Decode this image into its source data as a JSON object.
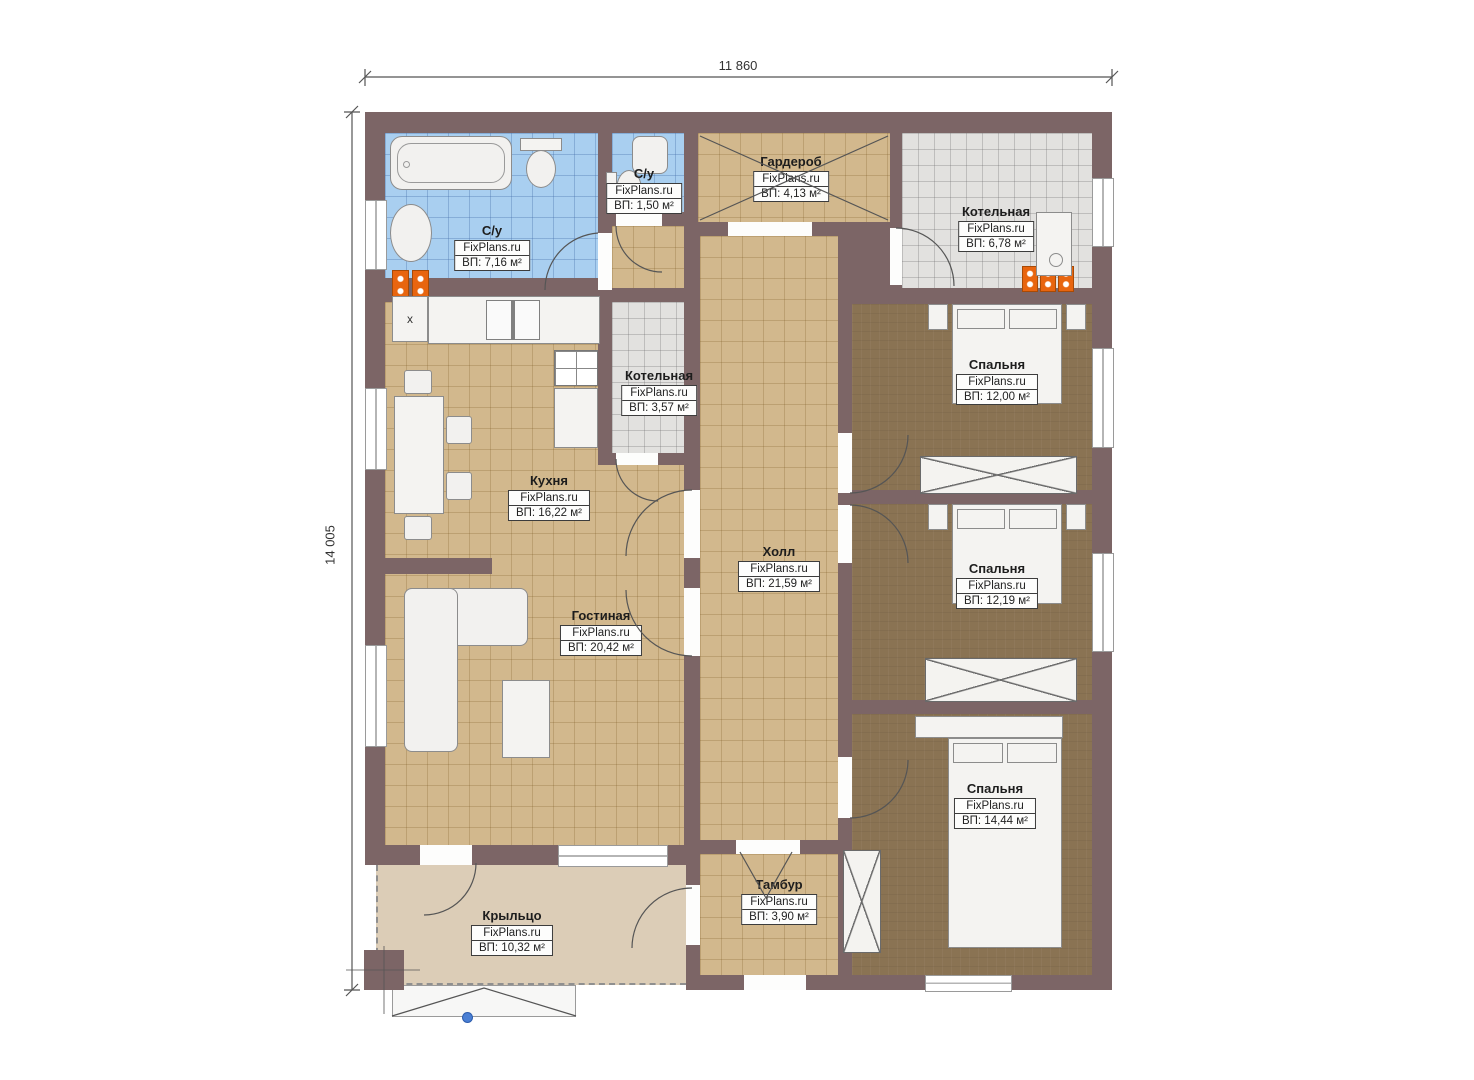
{
  "dimensions": {
    "width_label": "11 860",
    "height_label": "14 005"
  },
  "watermark": "FixPlans.ru",
  "rooms": [
    {
      "name": "С/у",
      "watermark": "FixPlans.ru",
      "area": "ВП: 7,16 м²"
    },
    {
      "name": "С/у",
      "watermark": "FixPlans.ru",
      "area": "ВП: 1,50 м²"
    },
    {
      "name": "Гардероб",
      "watermark": "FixPlans.ru",
      "area": "ВП: 4,13 м²"
    },
    {
      "name": "Котельная",
      "watermark": "FixPlans.ru",
      "area": "ВП: 6,78 м²"
    },
    {
      "name": "Котельная",
      "watermark": "FixPlans.ru",
      "area": "ВП: 3,57 м²"
    },
    {
      "name": "Кухня",
      "watermark": "FixPlans.ru",
      "area": "ВП: 16,22 м²"
    },
    {
      "name": "Холл",
      "watermark": "FixPlans.ru",
      "area": "ВП: 21,59 м²"
    },
    {
      "name": "Гостиная",
      "watermark": "FixPlans.ru",
      "area": "ВП: 20,42 м²"
    },
    {
      "name": "Спальня",
      "watermark": "FixPlans.ru",
      "area": "ВП: 12,00 м²"
    },
    {
      "name": "Спальня",
      "watermark": "FixPlans.ru",
      "area": "ВП: 12,19 м²"
    },
    {
      "name": "Спальня",
      "watermark": "FixPlans.ru",
      "area": "ВП: 14,44 м²"
    },
    {
      "name": "Тамбур",
      "watermark": "FixPlans.ru",
      "area": "ВП: 3,90 м²"
    },
    {
      "name": "Крыльцо",
      "watermark": "FixPlans.ru",
      "area": "ВП: 10,32 м²"
    }
  ],
  "misc": {
    "washer_mark": "x"
  },
  "colors": {
    "wall": "#7c6566",
    "tile_tan": "#d2b88d",
    "tile_blue": "#a9cff0",
    "tile_gray": "#e2e1df",
    "carpet": "#8a7353",
    "porch": "#dccdb7",
    "radiator": "#e8650f",
    "marker": "#4a7fd4"
  }
}
